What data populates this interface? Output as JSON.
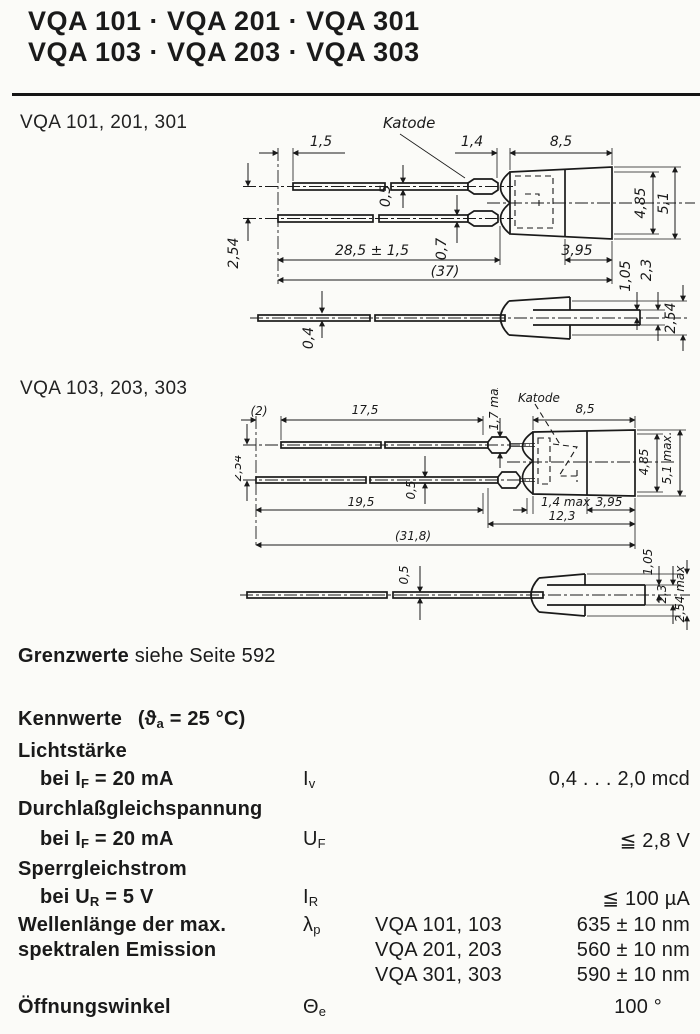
{
  "colors": {
    "ink": "#1a1a1a",
    "paper": "#fbfbf8"
  },
  "header": {
    "title_line1": "VQA 101 · VQA 201 · VQA 301",
    "title_line2": "VQA 103 · VQA 203 · VQA 303"
  },
  "drawing1": {
    "section_label": "VQA 101, 201, 301",
    "katode_label": "Katode",
    "dims": {
      "lead_offset": "1,5",
      "dome_len": "1,4",
      "body_len": "8,5",
      "lead_thick_top": "0,5",
      "lead_thick_bot": "0,7",
      "lead_pitch": "2,54",
      "lead_len": "28,5 ± 1,5",
      "total_len": "(37)",
      "body_h_inner": "4,85",
      "body_h_outer": "5,1",
      "cap_len": "3,95",
      "tail_half": "1,05",
      "tail_h": "2,3",
      "flat_thick": "0,4",
      "tail_w": "2,54"
    }
  },
  "drawing2": {
    "section_label": "VQA 103, 203, 303",
    "katode_label": "Katode",
    "dims": {
      "lead_offset": "(2)",
      "lead_len_top": "17,5",
      "crimp_h": "1,7 max",
      "body_len": "8,5",
      "lead_pitch": "2,54",
      "lead_thick": "0,5",
      "lead_len_bot": "19,5",
      "dome_len": "1,4 max",
      "cap_len": "3,95",
      "body_total": "12,3",
      "total_len": "(31,8)",
      "body_h_inner": "4,85",
      "body_h_outer": "5,1 max.",
      "flat_thick": "0,5",
      "tail_half": "1,05",
      "tail_h": "2,3",
      "tail_w": "2,54 max"
    }
  },
  "notes": {
    "grenzwerte_bold": "Grenzwerte",
    "grenzwerte_rest": "siehe Seite 592"
  },
  "kennwerte": {
    "heading": "Kennwerte",
    "cond_pre": "(ϑ",
    "cond_sub": "a",
    "cond_post": " = 25 °C)"
  },
  "table": {
    "rows": {
      "lichtstaerke": {
        "param": "Lichtstärke",
        "cond_pre": "bei I",
        "cond_sub": "F",
        "cond_post": " = 20 mA",
        "sym_main": "I",
        "sym_sub": "v",
        "value": "0,4 . . . 2,0 mcd"
      },
      "durchlass": {
        "param": "Durchlaßgleichspannung",
        "cond_pre": "bei I",
        "cond_sub": "F",
        "cond_post": " = 20 mA",
        "sym_main": "U",
        "sym_sub": "F",
        "value": "≦ 2,8 V"
      },
      "sperr": {
        "param": "Sperrgleichstrom",
        "cond_pre": "bei U",
        "cond_sub": "R",
        "cond_post": " = 5 V",
        "sym_main": "I",
        "sym_sub": "R",
        "value": "≦ 100 µA"
      },
      "wellenlaenge": {
        "param_line1": "Wellenlänge der max.",
        "param_line2": "spektralen Emission",
        "sym_main": "λ",
        "sym_sub": "p",
        "variants": [
          {
            "name": "VQA 101, 103",
            "value": "635 ± 10 nm"
          },
          {
            "name": "VQA 201, 203",
            "value": "560 ± 10 nm"
          },
          {
            "name": "VQA 301, 303",
            "value": "590 ± 10 nm"
          }
        ]
      },
      "oeffnung": {
        "param": "Öffnungswinkel",
        "sym_main": "Θ",
        "sym_sub": "e",
        "value": "100 °"
      }
    }
  }
}
